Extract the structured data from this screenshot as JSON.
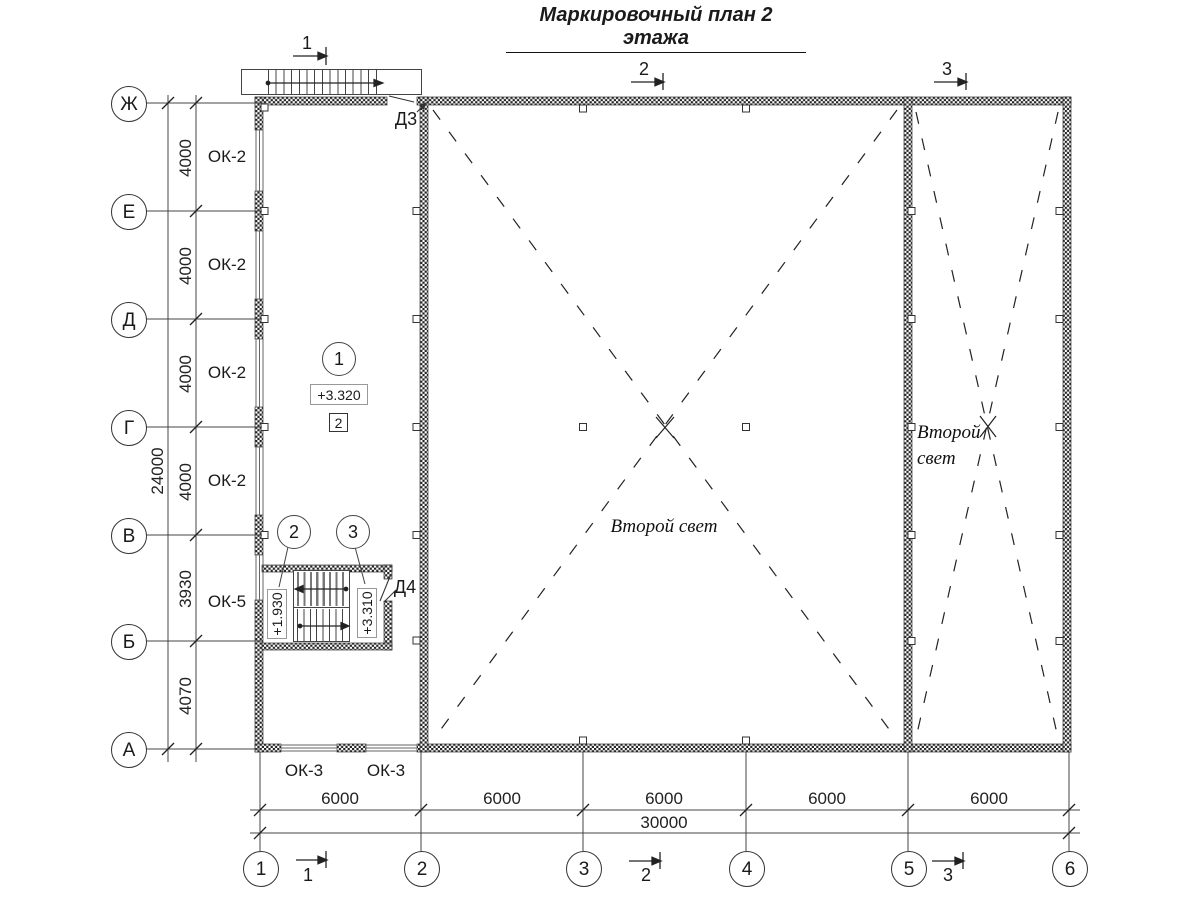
{
  "title": "Маркировочный план 2 этажа",
  "rows": [
    "Ж",
    "Е",
    "Д",
    "Г",
    "В",
    "Б",
    "А"
  ],
  "cols": [
    "1",
    "2",
    "3",
    "4",
    "5",
    "6"
  ],
  "left_dims": [
    "4000",
    "4000",
    "4000",
    "4000",
    "3930",
    "4070"
  ],
  "left_total": "24000",
  "bottom_dims": [
    "6000",
    "6000",
    "6000",
    "6000",
    "6000"
  ],
  "bottom_total": "30000",
  "windows": {
    "ok2": "ОК-2",
    "ok5": "ОК-5",
    "ok3": "ОК-3"
  },
  "doors": {
    "d3": "Д3",
    "d4": "Д4"
  },
  "levels": {
    "floor": "+3.320",
    "mid": "+1.930",
    "upper": "+3.310"
  },
  "markers": {
    "c1": "1",
    "c2": "2",
    "c3": "3",
    "sq": "2"
  },
  "sections": {
    "s1": "1",
    "s2": "2",
    "s3": "3"
  },
  "voids": {
    "main": "Второй свет",
    "right": "Второй свет"
  }
}
